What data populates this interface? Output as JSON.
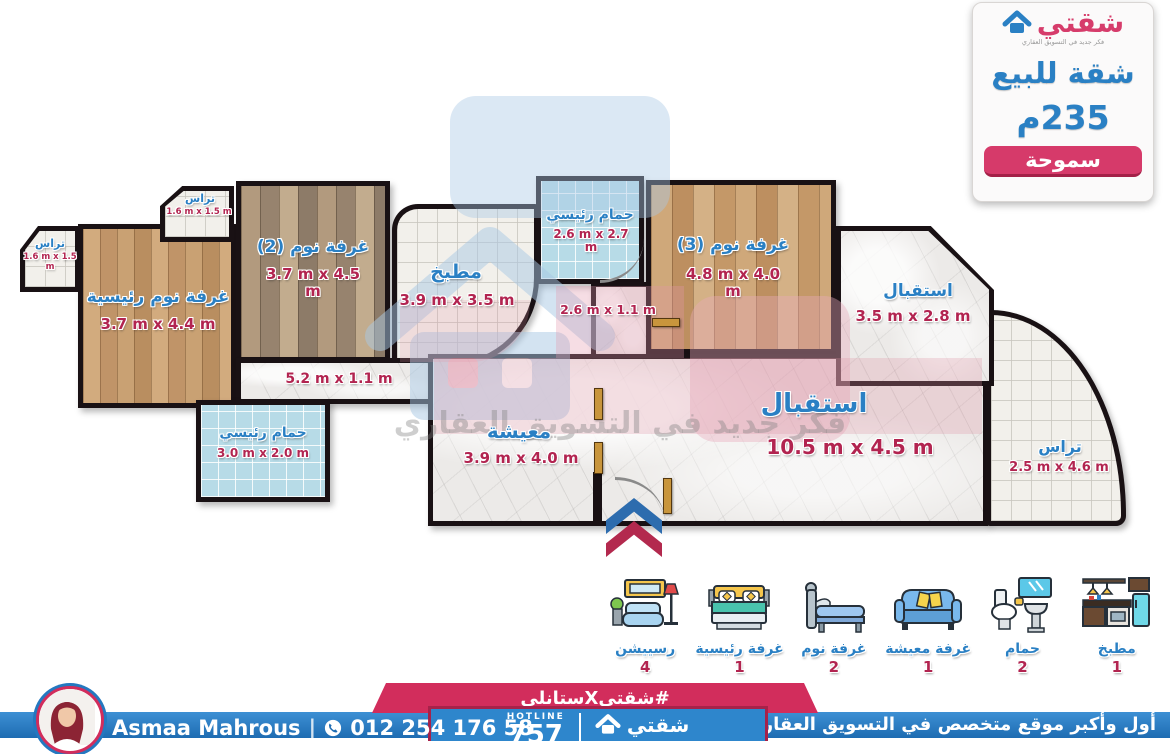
{
  "info_card": {
    "logo_text": "شقتي",
    "tagline": "فكر جديد في التسويق العقاري",
    "title": "شقة للبيع",
    "area": "235م",
    "location": "سموحة"
  },
  "watermark": {
    "text": "فكر جديد في التسويق العقاري"
  },
  "rooms": [
    {
      "id": "terrace-far-left",
      "name": "تراس",
      "dims": "1.6 m x 1.5 m"
    },
    {
      "id": "terrace-top",
      "name": "تراس",
      "dims": "1.6 m x 1.5 m"
    },
    {
      "id": "master-bedroom",
      "name": "غرفة نوم رئيسية",
      "dims": "3.7 m x 4.4 m"
    },
    {
      "id": "bedroom-2",
      "name": "غرفة نوم (2)",
      "dims": "3.7 m x 4.5 m"
    },
    {
      "id": "kitchen",
      "name": "مطبخ",
      "dims": "3.9 m x 3.5 m"
    },
    {
      "id": "bathroom-master-top",
      "name": "حمام رئيسي",
      "dims": "2.6 m x 2.7 m"
    },
    {
      "id": "corridor-small",
      "name": "",
      "dims": "2.6 m x 1.1 m"
    },
    {
      "id": "bedroom-3",
      "name": "غرفة نوم (3)",
      "dims": "4.8 m x 4.0 m"
    },
    {
      "id": "reception-upper",
      "name": "استقبال",
      "dims": "3.5 m x 2.8 m"
    },
    {
      "id": "reception-main",
      "name": "استقبال",
      "dims": "10.5 m x 4.5 m"
    },
    {
      "id": "living",
      "name": "معيشة",
      "dims": "3.9 m x 4.0 m"
    },
    {
      "id": "corridor-long",
      "name": "",
      "dims": "5.2 m x 1.1 m"
    },
    {
      "id": "bathroom-master-low",
      "name": "حمام رئيسي",
      "dims": "3.0 m x 2.0 m"
    },
    {
      "id": "terrace-right",
      "name": "تراس",
      "dims": "2.5 m x 4.6 m"
    }
  ],
  "legend": [
    {
      "label": "رسييشن",
      "count": "4",
      "icon": "reception-icon"
    },
    {
      "label": "غرفة رئيسية",
      "count": "1",
      "icon": "master-bedroom-icon"
    },
    {
      "label": "غرفة نوم",
      "count": "2",
      "icon": "bedroom-icon"
    },
    {
      "label": "غرفة معيشة",
      "count": "1",
      "icon": "living-room-icon"
    },
    {
      "label": "حمام",
      "count": "2",
      "icon": "bathroom-icon"
    },
    {
      "label": "مطبخ",
      "count": "1",
      "icon": "kitchen-icon"
    }
  ],
  "footer": {
    "hashtag": "#شقتيXستانلي",
    "agent_name": "Asmaa Mahrous",
    "agent_phone": "012 254 176 58",
    "hotline_label": "HOTLINE",
    "hotline_number": "757",
    "brand": "شقتي",
    "right_text": "أول وأكبر موقع متخصص في التسويق العقاري بالاسكندرية"
  },
  "colors": {
    "brand_pink": "#d63c6b",
    "brand_blue": "#2a80c4",
    "dim_red": "#b22450",
    "wall_black": "#191114",
    "ribbon_pink": "#d22d5c",
    "footer_blue": "#2478c0"
  }
}
